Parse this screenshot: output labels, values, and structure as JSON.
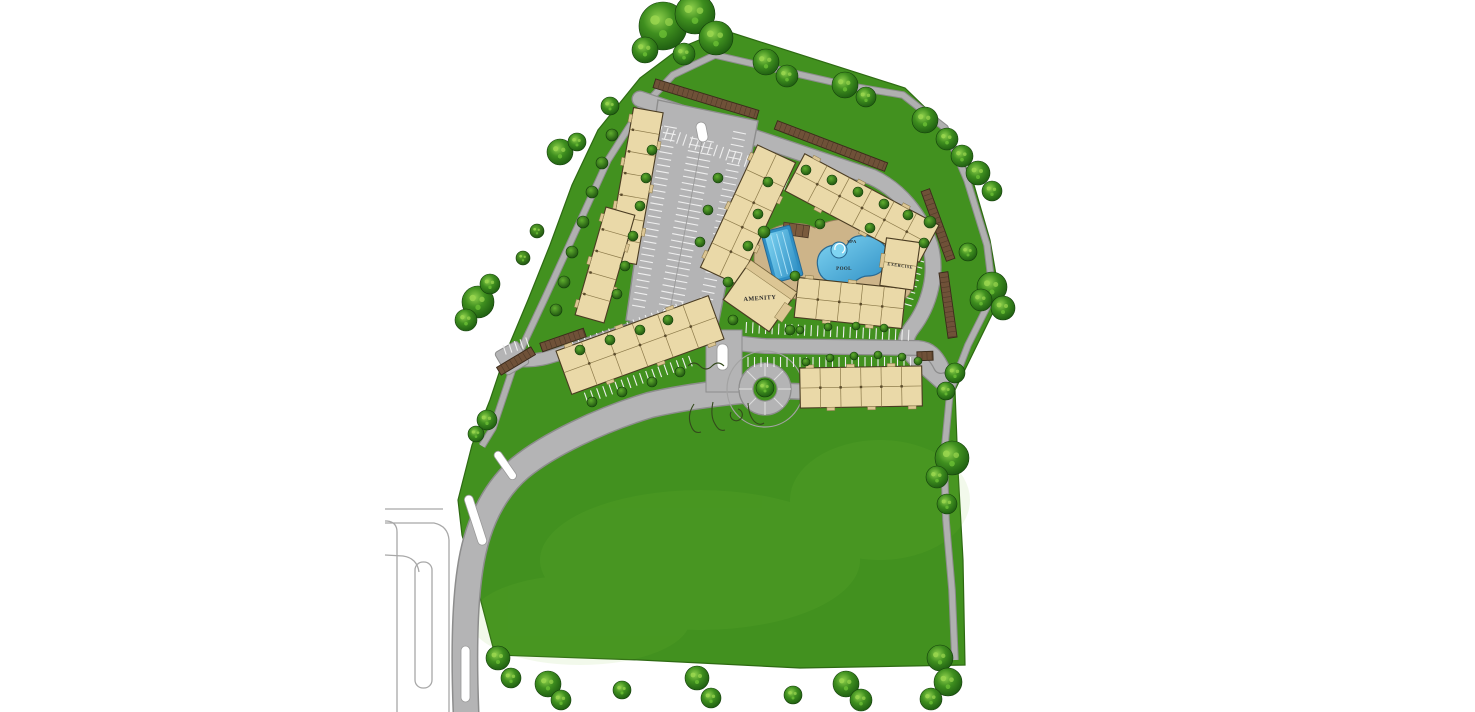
{
  "page": {
    "background": "#ffffff",
    "description": "Color site plan rendering of an apartment community with pool, spa, amenity and exercise buildings"
  },
  "plan": {
    "labels": {
      "amenity": "AMENITY",
      "pool": "POOL",
      "spa": "SPA",
      "exercise": "EXERCISE"
    },
    "features": {
      "residential_buildings": 7,
      "amenity_building": 1,
      "exercise_building": 1,
      "pools": [
        "lap pool",
        "free-form pool with spa"
      ],
      "roundabout": 1,
      "entry_drive": 1,
      "carport_rows": 7,
      "surface_parking": true,
      "perimeter_walking_path": true
    },
    "colors": {
      "grass": "#42911f",
      "grass_edge": "#2e6a13",
      "road": "#b4b4b5",
      "road_edge": "#8d8d8d",
      "path": "#b0b0b0",
      "stall_stripe": "#efefef",
      "median": "#ffffff",
      "building_fill": "#ead9a8",
      "building_edge": "#4a3c22",
      "building_line": "#8c7a4a",
      "building_bump": "#dcc694",
      "carport_fill": "#6f5138",
      "carport_edge": "#3a2a1a",
      "carport_rib": "#503b28",
      "deck": "#cdb489",
      "deck_edge": "#94805a",
      "water_light": "#7fd4f2",
      "water": "#55b8e8",
      "water_deep": "#2f8fc4",
      "water_edge": "#2a6a93",
      "label_text": "#2b2b2b",
      "tree_light": "#8fd14c",
      "tree_mid": "#3f8f1f",
      "tree_dark": "#1c5a10",
      "sketch": "#33491c"
    }
  }
}
